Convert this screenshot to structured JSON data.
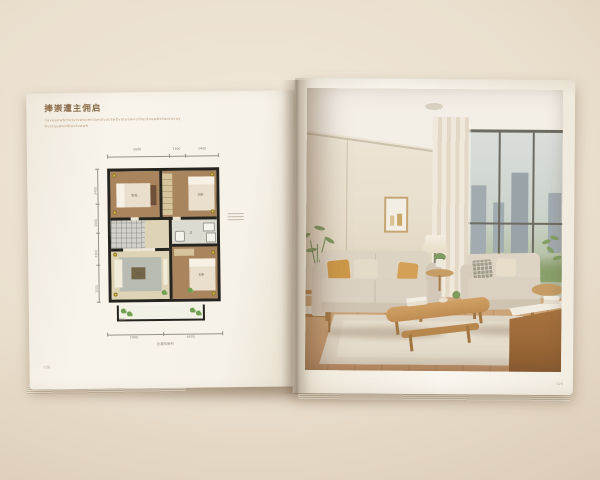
{
  "palette": {
    "backdrop": "#e8dcc9",
    "page": "#f6f2e9",
    "plan_wall": "#26241f",
    "plan_wood_floor": "#a9845c",
    "plan_accent_yellow": "#e0bf4e",
    "plan_plant_green": "#6fa052",
    "photo_wall": "#e9e0d0",
    "photo_wood": "#b98a55",
    "photo_pillow_mustard": "#cd9848"
  },
  "left_page": {
    "title": "捧崇遭主佣启",
    "subtitle_line1": "naveaowbmotelvwoaetvbeolvaotwbvoteawvolbeotvawbelwotevay",
    "subtitle_line2": "bvoteawvolbeotvawb",
    "page_number": "038",
    "floor_plan": {
      "dims_top": [
        "2600",
        "1300",
        "2400"
      ],
      "dims_left": [
        "3400",
        "1500",
        "3300",
        "1200"
      ],
      "dims_bottom": [
        "2900",
        "4600"
      ],
      "caption": "总建筑面积",
      "rooms": {
        "bedroom1": "卧室",
        "bedroom2": "次卧",
        "bathroom": "卫",
        "living": "客厅",
        "bedroom3": "主卧",
        "balcony": "阳台"
      }
    }
  },
  "right_page": {
    "page_number": "029"
  }
}
